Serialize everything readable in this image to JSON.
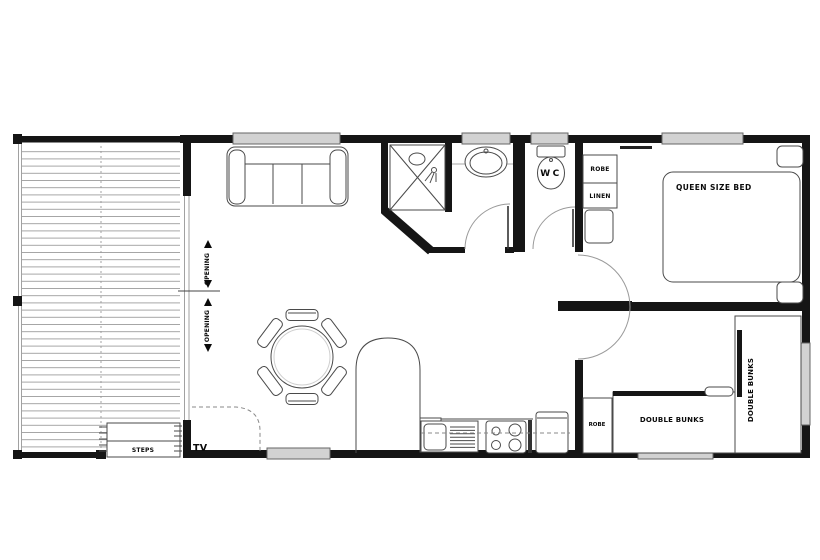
{
  "labels": {
    "queen_bed": "QUEEN SIZE BED",
    "double_bunks_h": "DOUBLE BUNKS",
    "double_bunks_v": "DOUBLE BUNKS",
    "robe_bedroom": "ROBE",
    "linen": "LINEN",
    "robe_bunkroom": "ROBE",
    "wc": "WC",
    "steps": "STEPS",
    "tv": "TV",
    "opening_upper": "OPENING",
    "opening_lower": "OPENING"
  },
  "colors": {
    "wall": "#151515",
    "window_fill": "#d2d2d2",
    "window_border": "#666666",
    "furniture_line": "#4a4a4a",
    "deck_board": "#909090",
    "dashed_line": "#8a8a8a",
    "text": "#0a0a0a",
    "background": "#ffffff"
  }
}
